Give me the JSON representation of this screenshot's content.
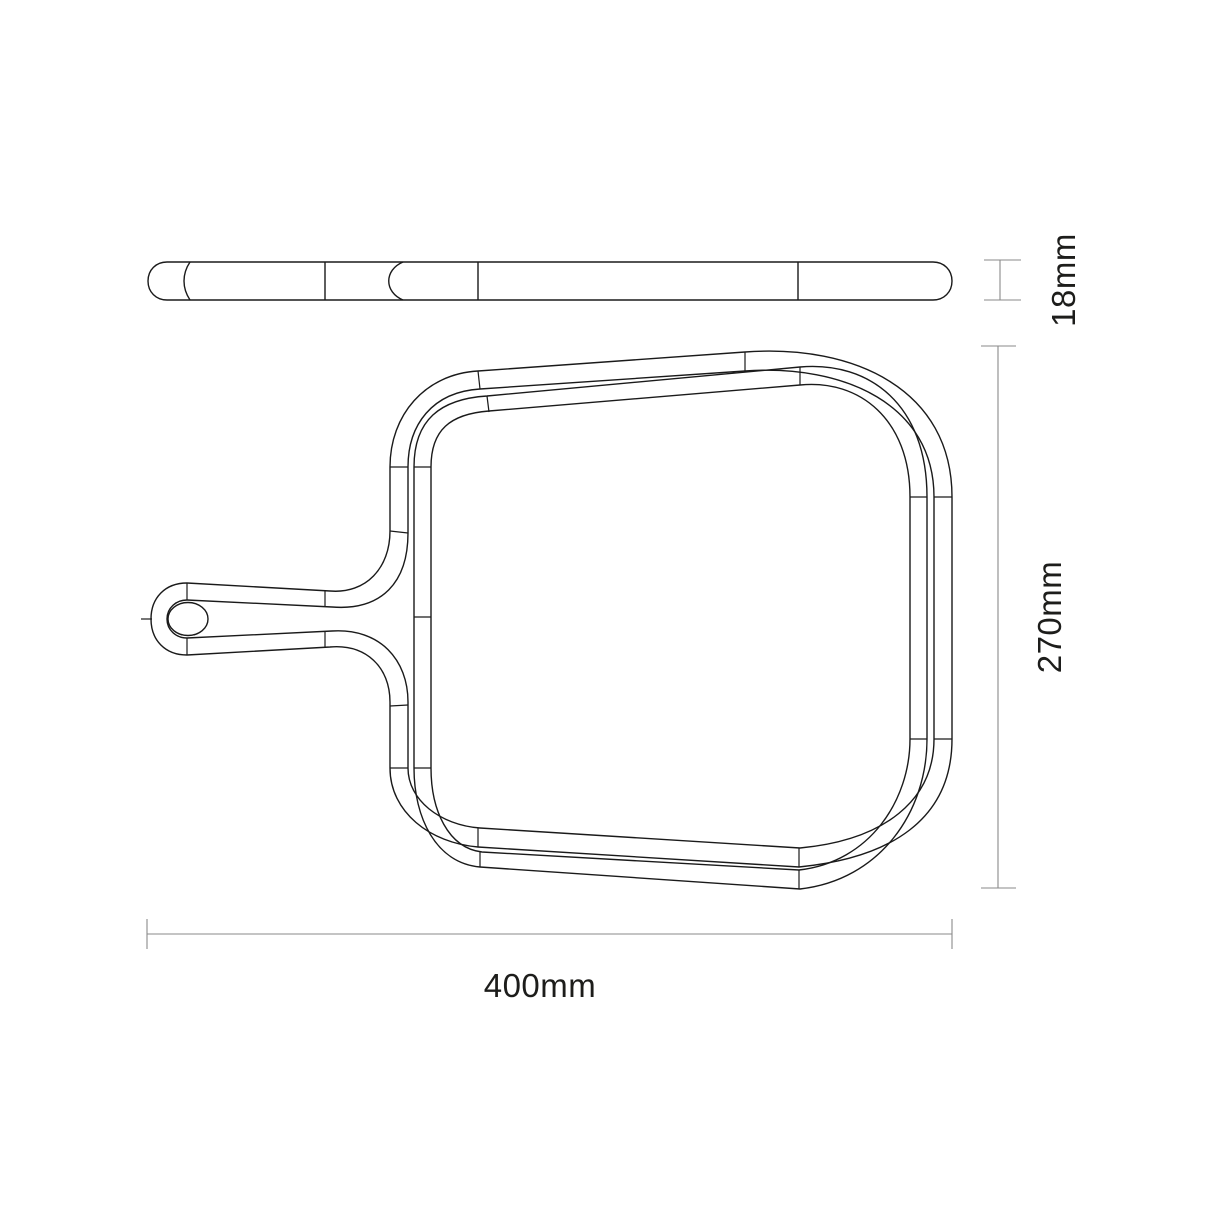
{
  "drawing": {
    "title": "skimmer-net-frame-technical-drawing",
    "object": "pool leaf skimmer frame with handle socket",
    "views": [
      {
        "id": "side-profile-view",
        "description": "thin slab edge profile with segment joints, shown above plan view"
      },
      {
        "id": "top-plan-view",
        "description": "rounded-square double ring frame with tapered handle socket and oval pole hole on left"
      }
    ],
    "dimensions": [
      {
        "id": "thickness",
        "label": "18mm",
        "value": 18,
        "unit": "mm",
        "orientation": "vertical",
        "measures": "profile thickness of frame"
      },
      {
        "id": "depth",
        "label": "270mm",
        "value": 270,
        "unit": "mm",
        "orientation": "vertical",
        "measures": "front-to-back size of frame"
      },
      {
        "id": "width",
        "label": "400mm",
        "value": 400,
        "unit": "mm",
        "orientation": "horizontal",
        "measures": "overall width including handle socket"
      }
    ],
    "colors": {
      "line": "#1a1a1a",
      "dimension_line": "#8a8a8a",
      "text": "#1d1d1b",
      "background": "#ffffff"
    }
  }
}
